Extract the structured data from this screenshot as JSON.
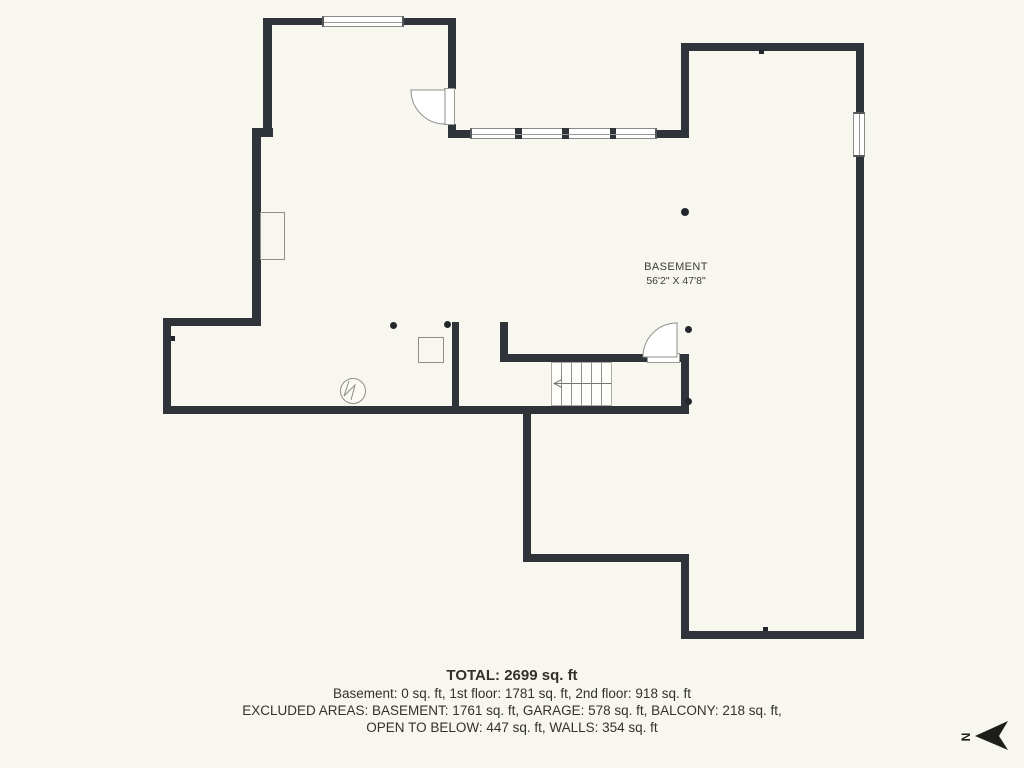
{
  "colors": {
    "background": "#f7f6ef",
    "wall": "#2e343a",
    "thin_line": "#8f8f88",
    "text": "#32322b"
  },
  "room_label": {
    "name": "BASEMENT",
    "dimensions": "56'2\" X 47'8\""
  },
  "area_summary": {
    "total": "TOTAL: 2699 sq. ft",
    "floors": "Basement: 0 sq. ft, 1st floor: 1781 sq. ft, 2nd floor: 918 sq. ft",
    "excluded_line1": "EXCLUDED AREAS: BASEMENT: 1761 sq. ft, GARAGE: 578 sq. ft, BALCONY: 218 sq. ft,",
    "excluded_line2": "OPEN TO BELOW: 447 sq. ft, WALLS: 354 sq. ft"
  },
  "compass": {
    "direction_label": "N"
  },
  "icons": {
    "north_arrow": "north-arrow-icon",
    "sump_pump": "sump-pump-icon",
    "door_swing": "door-swing-arc-icon",
    "stair_arrow": "stair-direction-arrow-icon"
  }
}
